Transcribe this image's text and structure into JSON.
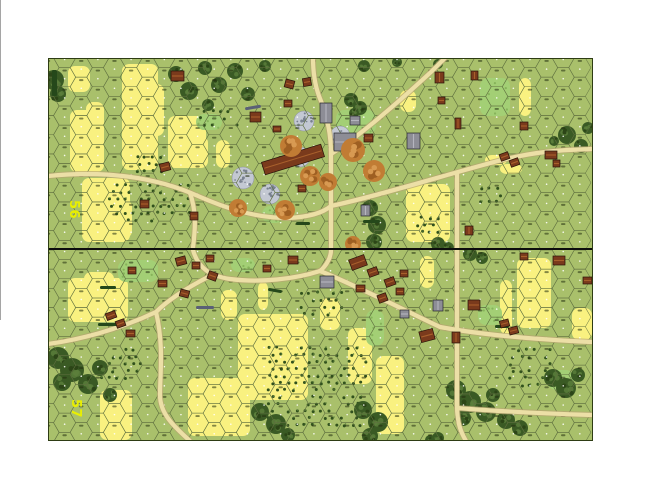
{
  "map": {
    "x": 48,
    "y": 58,
    "width": 545,
    "height": 383,
    "board_height": 190,
    "divider_y": 190,
    "divider_h": 2,
    "hex": {
      "cols": 33,
      "rows": 11,
      "col_spacing": 16.62,
      "row_height": 19.19,
      "radius": 11.08
    }
  },
  "colors": {
    "base": "#a9c06b",
    "grid": "#5f7040",
    "grain": "#f9f180",
    "woods_dark": "#3a5a24",
    "woods_mid": "#2c4517",
    "woods_light": "#5d7f3c",
    "brush": "#a3cf75",
    "brush_dot": "#86b35a",
    "orchard_dot": "#31511d",
    "road": "#ecdfa6",
    "road_edge": "#b7a671",
    "rubble": "#c3c8d3",
    "rubble_dot": "#79818f",
    "rubble_line": "#8a8fa0",
    "wood_bldg": "#7a3a1c",
    "wood_roof": "#a8602c",
    "wood_outline": "#28130a",
    "stone_bldg": "#8d8d96",
    "stone_roof": "#b5b5bf",
    "stone_outline": "#26262b",
    "hedge": "#25481a",
    "wall": "#5a6076",
    "orange": "#c17c34",
    "orange_dark": "#9e5f22",
    "orange_light": "#d89a52",
    "label": "#e9ef00",
    "divider": "#0d0d0d",
    "border": "#2e3c14",
    "hex_dot": "#ffffff",
    "hex_tick": "rgba(35,45,15,0.55)"
  },
  "boards": [
    {
      "label": "56",
      "label_pos": {
        "x": 22,
        "y": 142
      },
      "grain": [
        [
          20,
          8,
          22,
          26
        ],
        [
          22,
          52,
          34,
          62
        ],
        [
          38,
          44,
          18,
          36
        ],
        [
          74,
          6,
          36,
          106
        ],
        [
          98,
          26,
          18,
          52
        ],
        [
          120,
          58,
          38,
          52
        ],
        [
          142,
          78,
          18,
          32
        ],
        [
          168,
          82,
          14,
          28
        ],
        [
          34,
          120,
          48,
          64
        ],
        [
          62,
          142,
          22,
          38
        ],
        [
          352,
          32,
          16,
          22
        ],
        [
          437,
          97,
          22,
          10
        ],
        [
          452,
          106,
          22,
          10
        ],
        [
          471,
          20,
          12,
          38
        ],
        [
          358,
          126,
          44,
          58
        ],
        [
          376,
          152,
          24,
          32
        ],
        [
          388,
          144,
          13,
          36
        ]
      ],
      "brush": [
        [
          288,
          52,
          40,
          24
        ],
        [
          432,
          20,
          30,
          38
        ],
        [
          214,
          148,
          22,
          17
        ],
        [
          148,
          56,
          26,
          16
        ]
      ],
      "woods": [
        [
          [
            6,
            22,
            10
          ],
          [
            10,
            36,
            8
          ]
        ],
        [
          [
            128,
            16,
            8
          ],
          [
            141,
            33,
            9
          ],
          [
            157,
            10,
            7
          ],
          [
            171,
            27,
            8
          ],
          [
            187,
            13,
            8
          ],
          [
            200,
            36,
            7
          ],
          [
            160,
            47,
            6
          ],
          [
            217,
            8,
            6
          ]
        ],
        [
          [
            316,
            8,
            6
          ],
          [
            349,
            4,
            5
          ],
          [
            390,
            6,
            5
          ]
        ],
        [
          [
            303,
            42,
            7
          ],
          [
            312,
            50,
            7
          ],
          [
            306,
            55,
            5
          ]
        ],
        [
          [
            519,
            77,
            9
          ],
          [
            533,
            88,
            7
          ],
          [
            506,
            83,
            5
          ],
          [
            540,
            70,
            6
          ]
        ],
        [
          [
            322,
            150,
            8
          ],
          [
            329,
            167,
            9
          ],
          [
            326,
            184,
            8
          ]
        ],
        [
          [
            390,
            186,
            7
          ],
          [
            400,
            190,
            6
          ]
        ]
      ],
      "orchards": [
        [
          58,
          124,
          84,
          40
        ],
        [
          150,
          50,
          40,
          22
        ],
        [
          363,
          157,
          30,
          22
        ],
        [
          430,
          127,
          24,
          22
        ],
        [
          86,
          96,
          30,
          20
        ]
      ],
      "rubble": [
        [
          256,
          63,
          10
        ],
        [
          292,
          78,
          10
        ],
        [
          252,
          99,
          10
        ],
        [
          195,
          120,
          11
        ],
        [
          222,
          136,
          10
        ]
      ],
      "orange": [
        [
          243,
          88,
          11
        ],
        [
          262,
          118,
          10
        ],
        [
          190,
          150,
          9
        ],
        [
          237,
          152,
          10
        ],
        [
          326,
          113,
          11
        ],
        [
          280,
          124,
          9
        ],
        [
          305,
          92,
          12
        ],
        [
          305,
          186,
          8
        ]
      ],
      "buildings_wood": [
        [
          123,
          13,
          13,
          10,
          0
        ],
        [
          237,
          22,
          9,
          8,
          15
        ],
        [
          255,
          20,
          8,
          8,
          -10
        ],
        [
          236,
          42,
          8,
          7,
          0
        ],
        [
          202,
          54,
          11,
          10,
          0
        ],
        [
          225,
          68,
          8,
          6,
          0
        ],
        [
          112,
          105,
          10,
          8,
          -15
        ],
        [
          92,
          142,
          9,
          8,
          0
        ],
        [
          142,
          154,
          8,
          8,
          0
        ],
        [
          214,
          95,
          62,
          13,
          -17
        ],
        [
          250,
          127,
          8,
          7,
          0
        ],
        [
          316,
          76,
          9,
          8,
          0
        ],
        [
          387,
          14,
          9,
          11,
          0
        ],
        [
          423,
          13,
          7,
          9,
          0
        ],
        [
          390,
          39,
          7,
          7,
          0
        ],
        [
          407,
          60,
          6,
          11,
          0
        ],
        [
          472,
          64,
          8,
          8,
          0
        ],
        [
          452,
          95,
          9,
          7,
          -20
        ],
        [
          462,
          101,
          9,
          7,
          -20
        ],
        [
          505,
          102,
          7,
          7,
          0
        ],
        [
          497,
          93,
          12,
          8,
          0
        ],
        [
          417,
          168,
          8,
          9,
          0
        ]
      ],
      "buildings_stone": [
        [
          272,
          45,
          12,
          20,
          0
        ],
        [
          286,
          75,
          22,
          18,
          0
        ],
        [
          302,
          58,
          10,
          9,
          0
        ],
        [
          359,
          75,
          13,
          16,
          0
        ],
        [
          313,
          147,
          9,
          11,
          0
        ]
      ],
      "hedges": [
        [
          197,
          48,
          16,
          3,
          -10,
          "wall"
        ],
        [
          315,
          162,
          17,
          3,
          0,
          "hedge"
        ],
        [
          248,
          164,
          14,
          3,
          0,
          "hedge"
        ],
        [
          4,
          12,
          5,
          26,
          0,
          "hedge"
        ]
      ],
      "roads": [
        "M0,118 C60,112 110,120 150,138 C175,149 205,160 240,160 C262,159 276,154 283,148",
        "M142,135 C149,155 147,173 145,190",
        "M283,190 L283,148 L283,96",
        "M283,96 C283,72 277,52 271,38 C266,24 265,12 265,0",
        "M283,96 C315,76 357,38 383,14 L397,0",
        "M283,148 C330,138 400,116 450,103 C492,92 520,92 544,91",
        "M409,116 L409,190"
      ]
    },
    {
      "label": "57",
      "label_pos": {
        "x": 24,
        "y": 149
      },
      "grain": [
        [
          20,
          28,
          60,
          44
        ],
        [
          36,
          22,
          30,
          30
        ],
        [
          52,
          140,
          32,
          50
        ],
        [
          140,
          128,
          62,
          58
        ],
        [
          190,
          64,
          70,
          86
        ],
        [
          173,
          40,
          16,
          30
        ],
        [
          210,
          32,
          10,
          28
        ],
        [
          272,
          48,
          20,
          32
        ],
        [
          469,
          8,
          34,
          70
        ],
        [
          452,
          30,
          12,
          54
        ],
        [
          372,
          6,
          14,
          32
        ],
        [
          524,
          58,
          20,
          32
        ],
        [
          300,
          78,
          24,
          56
        ],
        [
          328,
          106,
          28,
          78
        ]
      ],
      "brush": [
        [
          70,
          10,
          40,
          22
        ],
        [
          318,
          60,
          18,
          36
        ],
        [
          430,
          55,
          24,
          20
        ],
        [
          183,
          8,
          24,
          14
        ],
        [
          500,
          120,
          26,
          20
        ]
      ],
      "woods": [
        [
          [
            10,
            108,
            11
          ],
          [
            24,
            120,
            12
          ],
          [
            40,
            134,
            10
          ],
          [
            14,
            132,
            9
          ],
          [
            52,
            118,
            8
          ],
          [
            62,
            145,
            7
          ]
        ],
        [
          [
            212,
            162,
            9
          ],
          [
            228,
            174,
            10
          ],
          [
            240,
            185,
            7
          ]
        ],
        [
          [
            315,
            160,
            9
          ],
          [
            330,
            172,
            10
          ],
          [
            322,
            186,
            8
          ]
        ],
        [
          [
            408,
            140,
            10
          ],
          [
            422,
            152,
            11
          ],
          [
            438,
            162,
            10
          ],
          [
            415,
            168,
            8
          ],
          [
            445,
            145,
            7
          ],
          [
            458,
            170,
            9
          ],
          [
            472,
            178,
            8
          ]
        ],
        [
          [
            505,
            128,
            9
          ],
          [
            518,
            138,
            10
          ],
          [
            530,
            125,
            7
          ]
        ],
        [
          [
            422,
            4,
            7
          ],
          [
            434,
            8,
            6
          ]
        ],
        [
          [
            390,
            188,
            6
          ],
          [
            382,
            190,
            5
          ]
        ]
      ],
      "orchards": [
        [
          218,
          95,
          100,
          85
        ],
        [
          50,
          97,
          44,
          33
        ],
        [
          459,
          97,
          46,
          43
        ],
        [
          250,
          40,
          44,
          28
        ]
      ],
      "rubble": [],
      "orange": [],
      "buildings_wood": [
        [
          128,
          7,
          10,
          8,
          -15
        ],
        [
          144,
          12,
          8,
          7,
          0
        ],
        [
          158,
          5,
          8,
          7,
          0
        ],
        [
          160,
          22,
          9,
          8,
          20
        ],
        [
          215,
          15,
          8,
          7,
          0
        ],
        [
          240,
          6,
          10,
          8,
          0
        ],
        [
          110,
          30,
          9,
          7,
          0
        ],
        [
          132,
          40,
          9,
          7,
          15
        ],
        [
          80,
          17,
          8,
          7,
          0
        ],
        [
          58,
          62,
          10,
          7,
          -20
        ],
        [
          68,
          70,
          9,
          7,
          -20
        ],
        [
          78,
          80,
          9,
          7,
          0
        ],
        [
          302,
          7,
          16,
          11,
          -20
        ],
        [
          320,
          18,
          10,
          8,
          -20
        ],
        [
          337,
          28,
          10,
          8,
          -20
        ],
        [
          308,
          35,
          9,
          7,
          0
        ],
        [
          330,
          44,
          9,
          8,
          -20
        ],
        [
          348,
          38,
          8,
          7,
          0
        ],
        [
          352,
          20,
          8,
          7,
          0
        ],
        [
          372,
          80,
          14,
          11,
          -15
        ],
        [
          404,
          82,
          8,
          11,
          0
        ],
        [
          420,
          50,
          12,
          10,
          0
        ],
        [
          452,
          70,
          9,
          7,
          -15
        ],
        [
          461,
          77,
          9,
          7,
          -15
        ],
        [
          505,
          6,
          12,
          9,
          0
        ],
        [
          472,
          3,
          8,
          7,
          0
        ],
        [
          535,
          27,
          9,
          7,
          0
        ]
      ],
      "buildings_stone": [
        [
          272,
          26,
          14,
          12,
          0
        ],
        [
          385,
          50,
          10,
          11,
          0
        ],
        [
          352,
          60,
          9,
          8,
          0
        ]
      ],
      "hedges": [
        [
          148,
          56,
          18,
          3,
          0,
          "wall"
        ],
        [
          50,
          73,
          20,
          3,
          0,
          "hedge"
        ],
        [
          220,
          39,
          14,
          3,
          10,
          "hedge"
        ],
        [
          447,
          75,
          14,
          3,
          0,
          "hedge"
        ],
        [
          52,
          36,
          16,
          3,
          0,
          "hedge"
        ]
      ],
      "roads": [
        "M145,0 C150,18 162,26 182,29 C212,33 247,29 272,21",
        "M283,0 C283,8 278,16 272,21",
        "M272,21 C305,34 360,62 392,77",
        "M392,77 C440,86 500,90 544,92",
        "M409,0 L409,155 C409,175 414,184 418,191",
        "M409,158 C460,162 510,164 544,165",
        "M160,27 C135,40 118,52 108,62 C70,80 30,90 0,94",
        "M108,62 C116,95 112,125 112,145 C112,165 128,178 142,191"
      ]
    }
  ]
}
